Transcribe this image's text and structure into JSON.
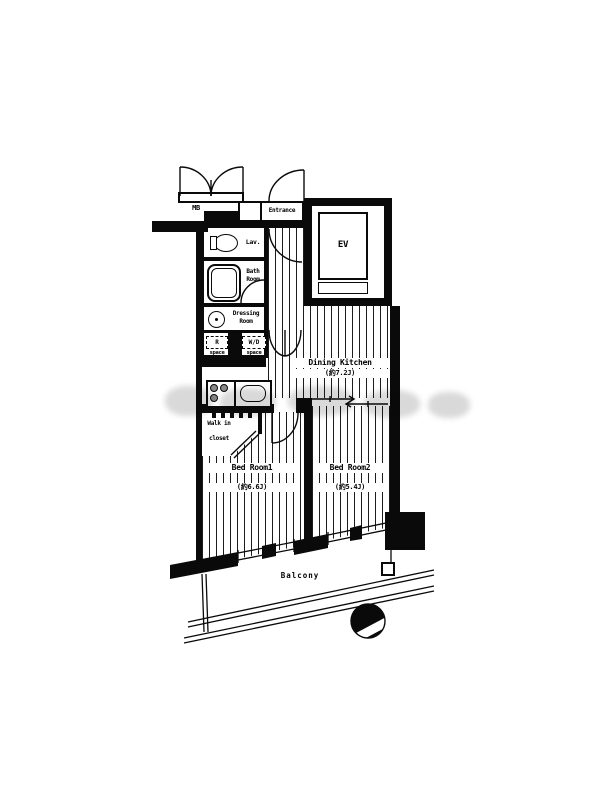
{
  "floorplan": {
    "mb": "MB",
    "entrance": "Entrance",
    "lav": "Lav.",
    "bath": "Bath Room",
    "dressing": "Dressing Room",
    "r_space": {
      "line1": "R",
      "line2": "space"
    },
    "wd_space": {
      "line1": "W/D",
      "line2": "space"
    },
    "ev": "EV",
    "dining_kitchen": {
      "name": "Dining Kitchen",
      "size": "(約7.2J)"
    },
    "bedroom1": {
      "name": "Bed Room1",
      "size": "(約6.6J)"
    },
    "bedroom2": {
      "name": "Bed Room2",
      "size": "(約5.4J)"
    },
    "walkin_closet": {
      "line1": "Walk in",
      "line2": "closet"
    },
    "balcony": "Balcony"
  }
}
